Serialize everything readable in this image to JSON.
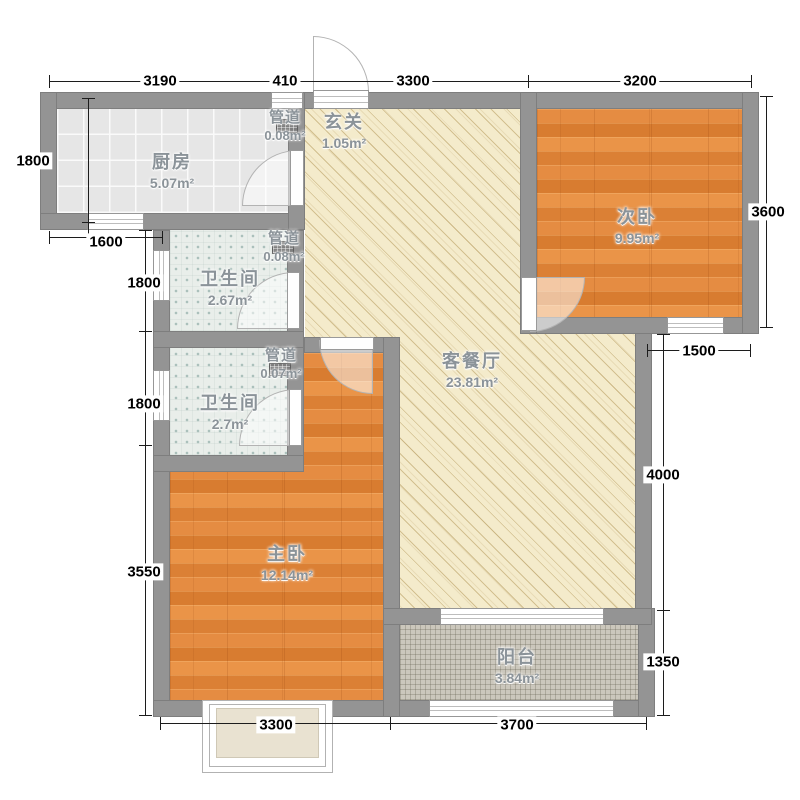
{
  "plan_type": "apartment-floor-plan",
  "rooms": {
    "kitchen": {
      "name": "厨房",
      "area": "5.07m²"
    },
    "entry": {
      "name": "玄关",
      "area": "1.05m²"
    },
    "duct_kitchen": {
      "name": "管道",
      "area": "0.08m²"
    },
    "bedroom2": {
      "name": "次卧",
      "area": "9.95m²"
    },
    "bath1": {
      "name": "卫生间",
      "area": "2.67m²"
    },
    "duct_bath1": {
      "name": "管道",
      "area": "0.08m²"
    },
    "bath2": {
      "name": "卫生间",
      "area": "2.7m²"
    },
    "duct_bath2": {
      "name": "管道",
      "area": "0.07m²"
    },
    "living": {
      "name": "客餐厅",
      "area": "23.81m²"
    },
    "master": {
      "name": "主卧",
      "area": "12.14m²"
    },
    "balcony": {
      "name": "阳台",
      "area": "3.84m²"
    }
  },
  "dimensions": {
    "top": [
      "3190",
      "410",
      "3300",
      "3200"
    ],
    "left": [
      "1800",
      "1600",
      "1800",
      "1800",
      "3550"
    ],
    "right": [
      "3600",
      "1500",
      "4000",
      "1350"
    ],
    "bottom": [
      "3300",
      "3700"
    ]
  },
  "colors": {
    "wall": "#949494",
    "wood_floor": "#E1873D",
    "living_floor": "#F4EBCB",
    "kitchen_floor": "#E6E6E6",
    "bath_floor": "#E9EEEA",
    "balcony_floor": "#CBC7BC",
    "room_label_text": "#8B9399",
    "dimension_text": "#000000"
  }
}
